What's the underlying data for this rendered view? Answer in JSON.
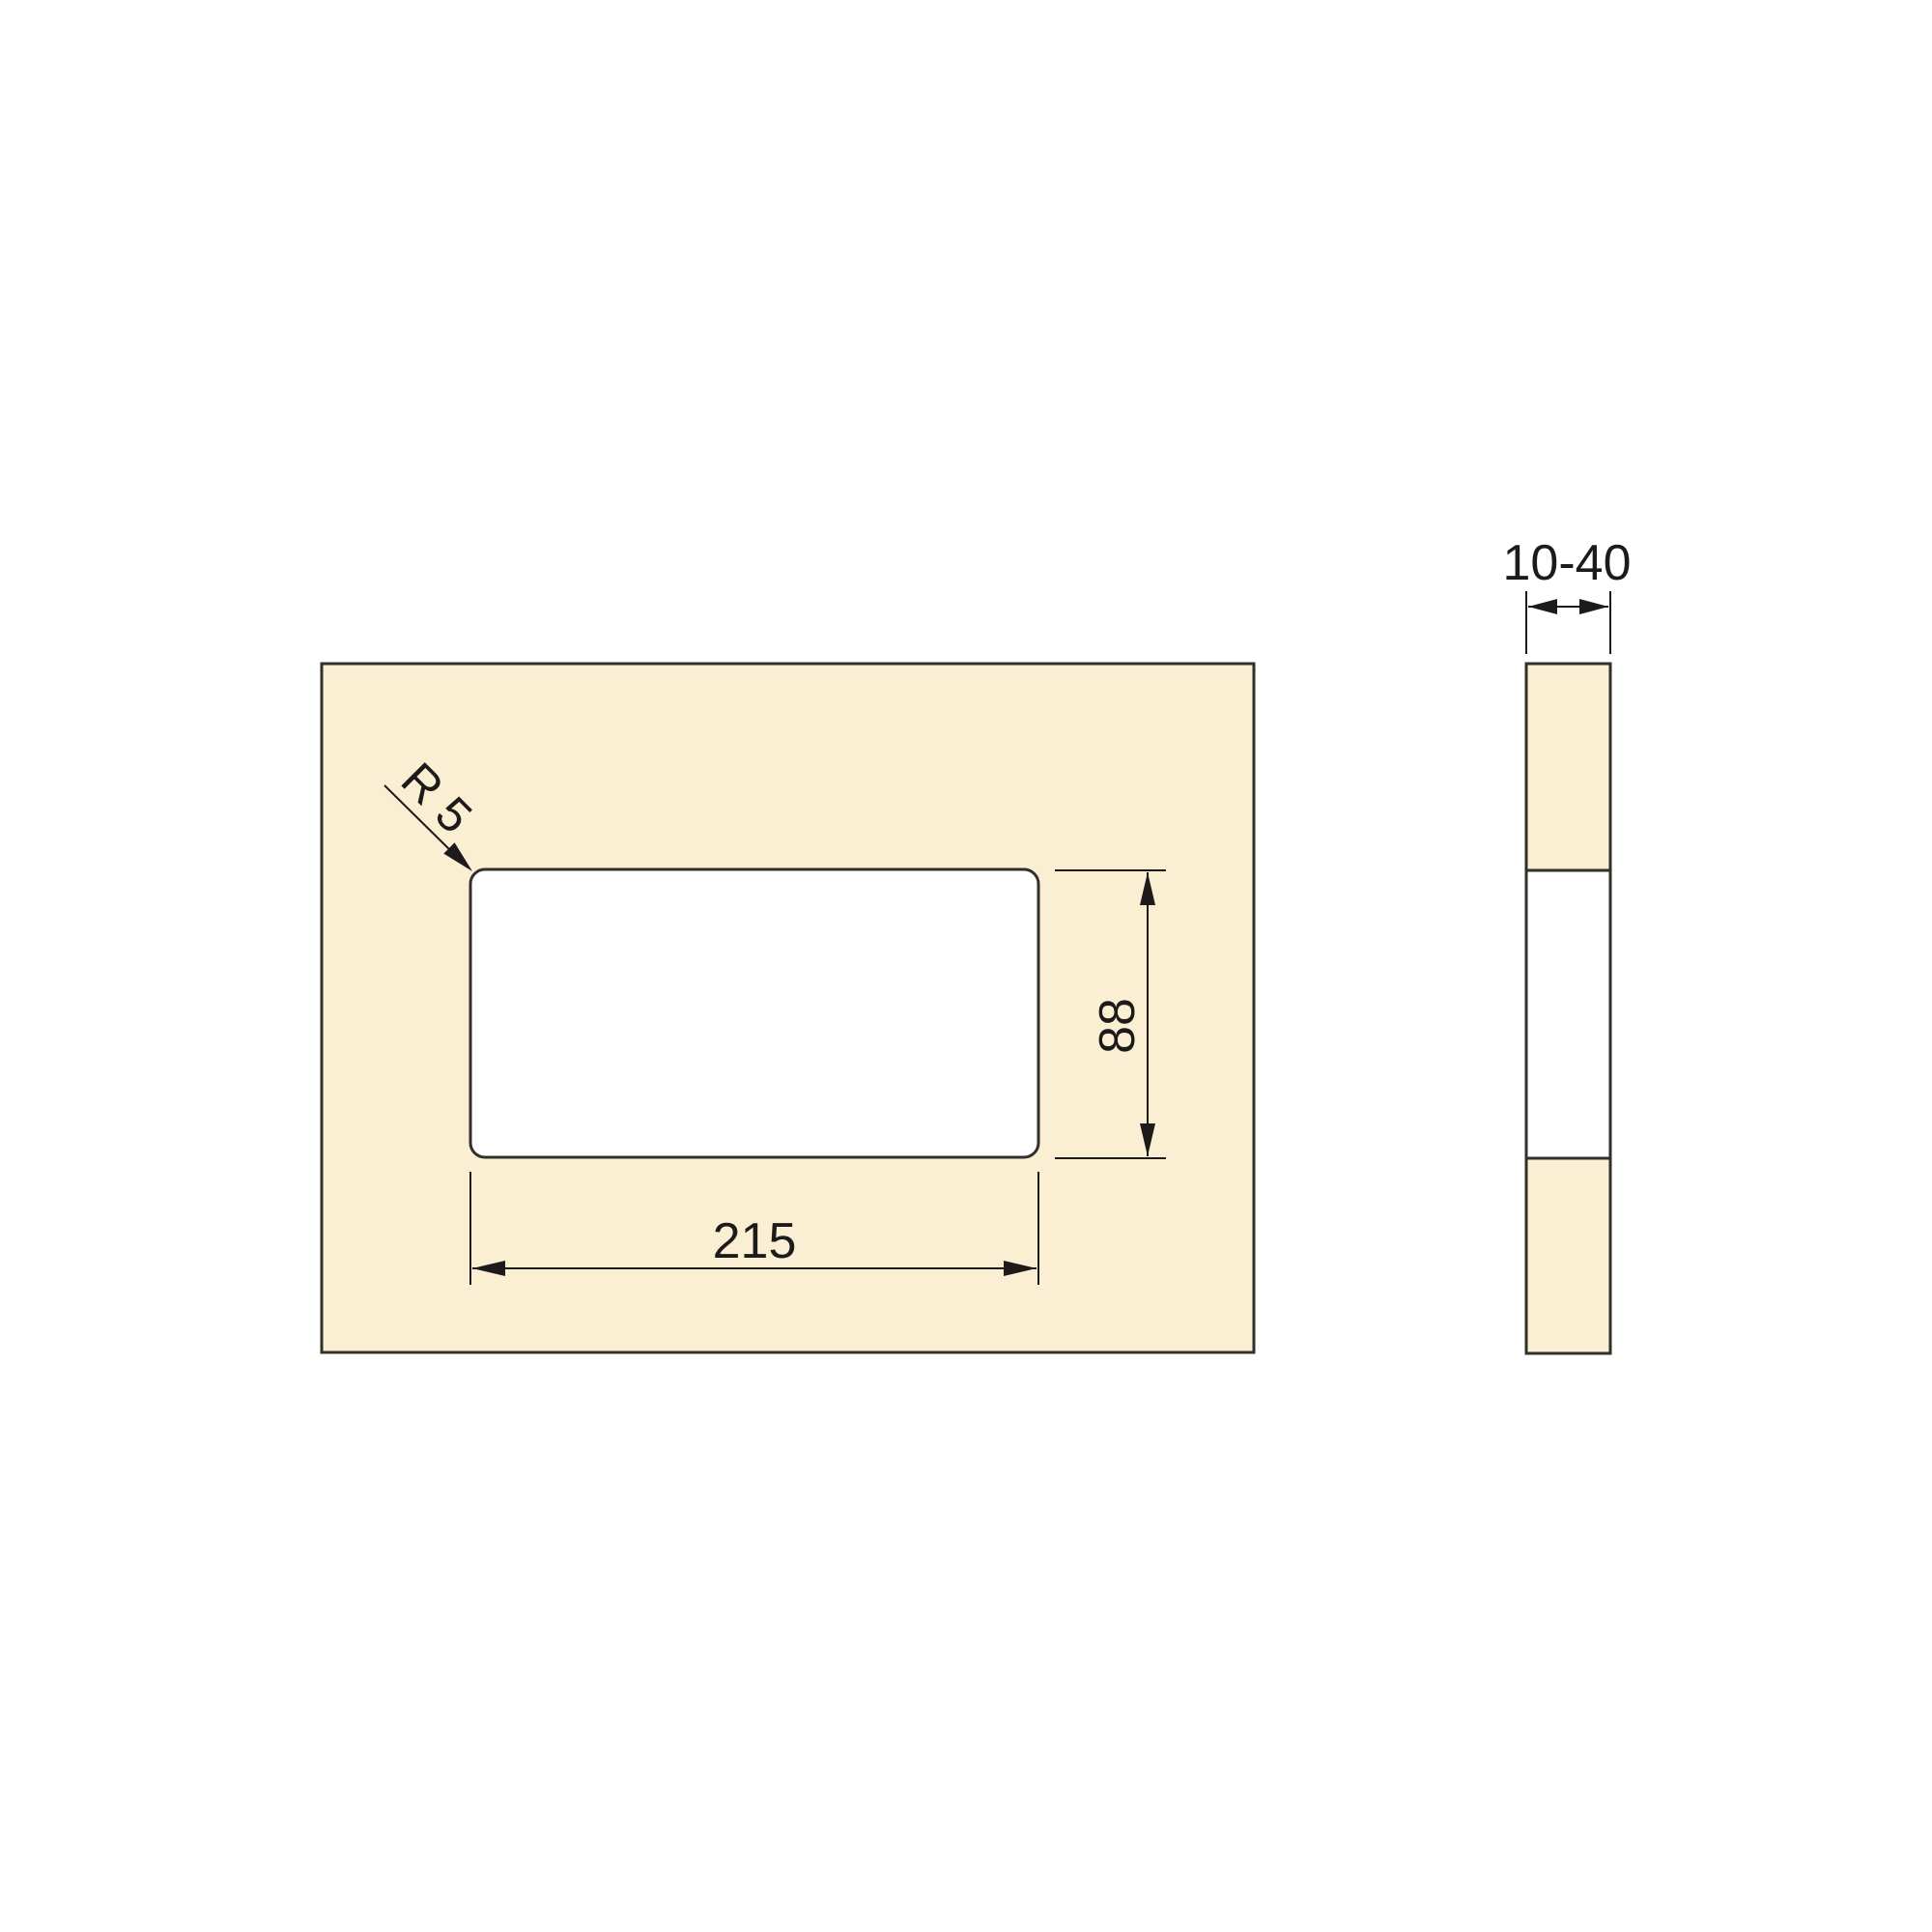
{
  "front_view": {
    "radius_label": "R 5",
    "height_dim_label": "88",
    "width_dim_label": "215"
  },
  "side_view": {
    "thickness_dim_label": "10-40"
  },
  "colors": {
    "background": "#FFFFFF",
    "panel_fill": "#FBEFD3",
    "cutout_fill": "#FFFFFF",
    "outline": "#31302A",
    "dimension": "#1C1B19"
  }
}
